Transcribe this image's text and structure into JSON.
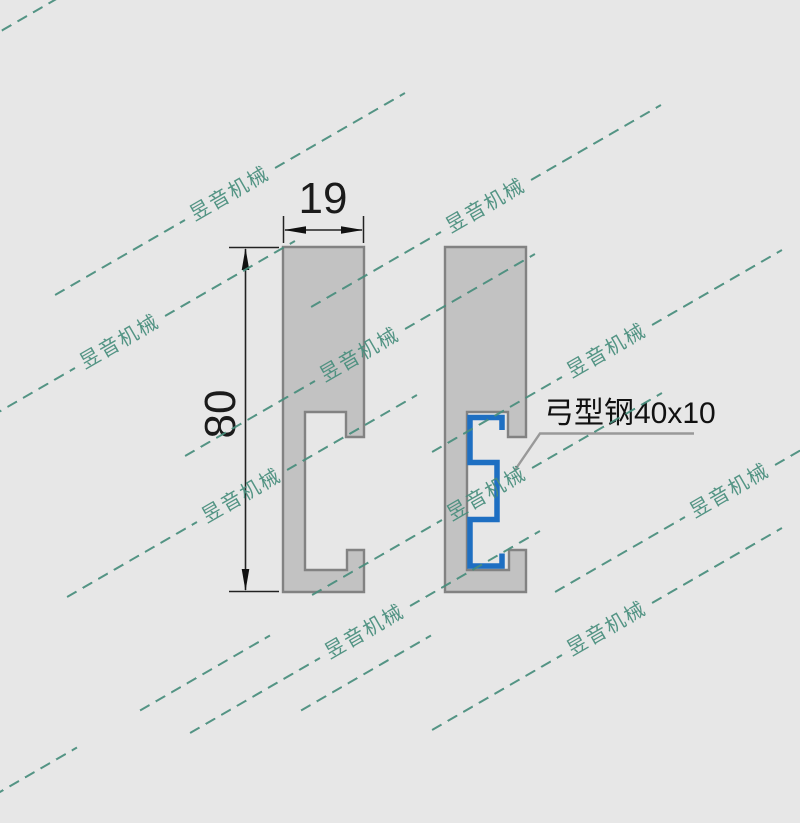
{
  "drawing": {
    "title_context": "steel channel profile cross-sections",
    "background_color": "#e7e7e7",
    "profile_fill_color": "#c2c2c2",
    "profile_stroke_color": "#828282",
    "bow_steel_color": "#1e6fc2",
    "dimension_line_color": "#222222",
    "leader_line_color": "#999999",
    "width_dimension": {
      "label": "19"
    },
    "height_dimension": {
      "label": "80"
    },
    "callout": {
      "label": "弓型钢40x10"
    }
  },
  "watermark": {
    "text": "昱音机械",
    "color": "#478d7c"
  }
}
